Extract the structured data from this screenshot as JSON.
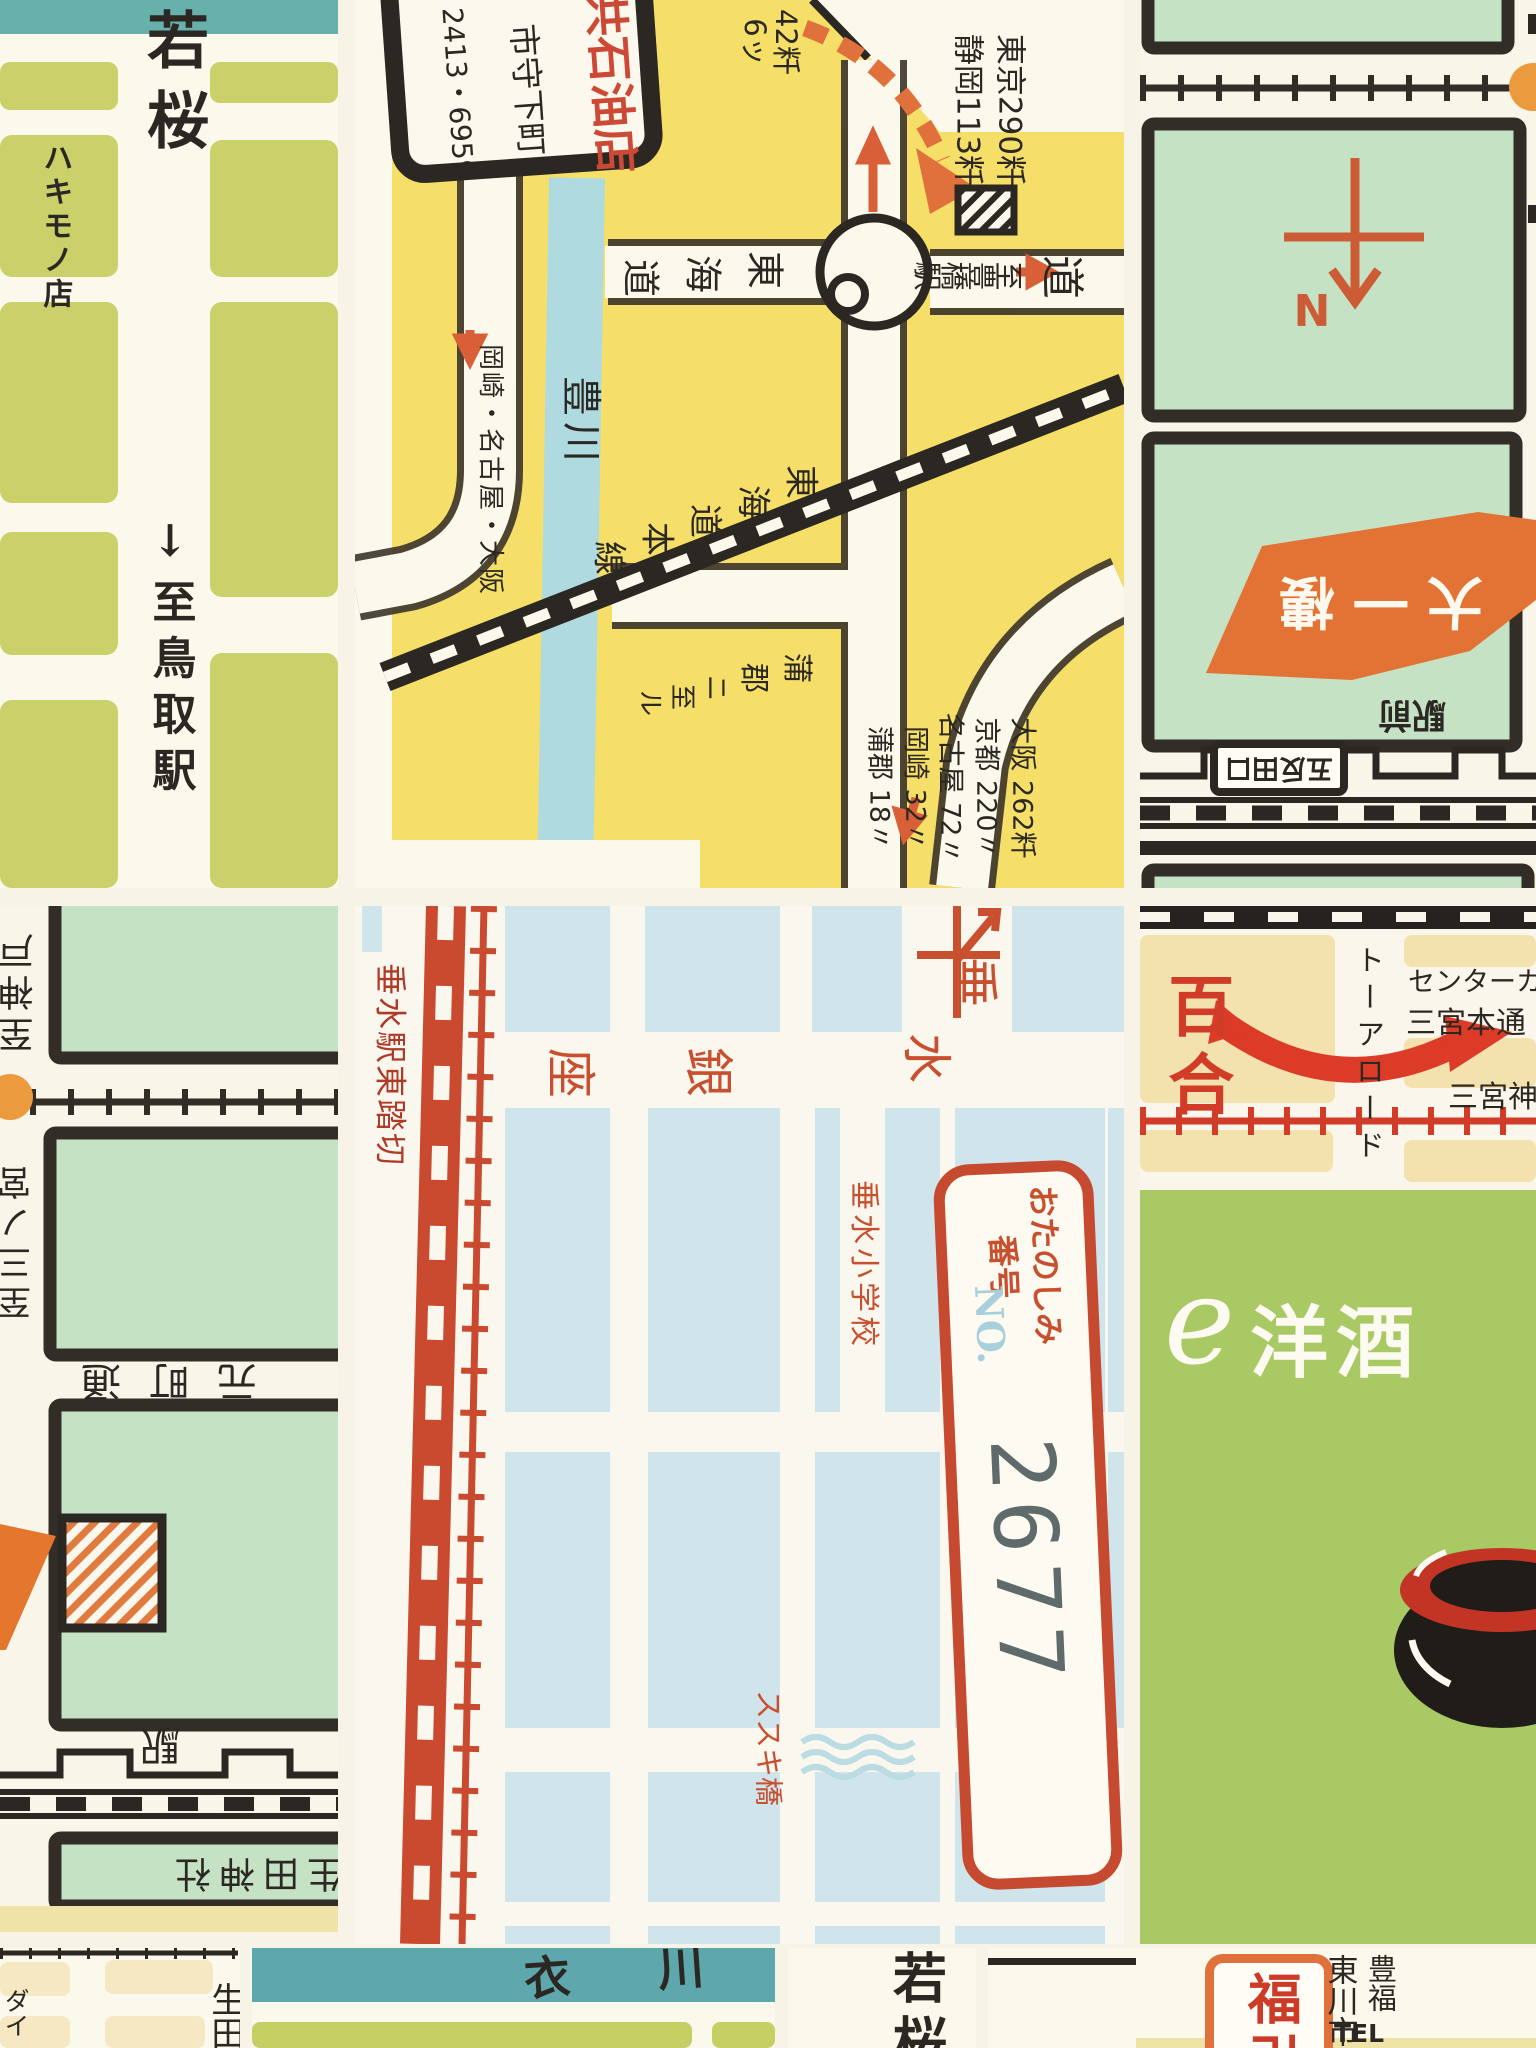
{
  "p1": {
    "street_name": "若桜",
    "shop": "ハキモノ店",
    "to_station": "↓至鳥取駅"
  },
  "p2": {
    "sign_shop": "共石油店",
    "sign_town": "市守下町",
    "sign_phone": "2413・6959",
    "km_small": [
      "42粁",
      "6ッ"
    ],
    "km_top": [
      "東京290粁",
      "静岡113粁"
    ],
    "river": "豊川",
    "road_dest": "岡崎・名古屋・大阪",
    "tokaido": [
      "東",
      "海",
      "道"
    ],
    "rail": [
      "東",
      "海",
      "道",
      "本",
      "線"
    ],
    "gamagori": [
      "蒲",
      "郡",
      "ニ",
      "至",
      "ル"
    ],
    "to_station": [
      "至",
      "豊",
      "橋",
      "駅"
    ],
    "road_char": "道",
    "km_list": [
      "大阪 262粁",
      "京都 220〃",
      "名古屋 72〃",
      "岡崎 32〃",
      "蒲郡 18〃"
    ]
  },
  "p3": {
    "compass": "N",
    "banner": "大一樓",
    "station_sign": "五反田口",
    "ekimae": "駅前"
  },
  "p4": {
    "to_kobe": "至神戸",
    "to_sannomiya": "至三ノ宮",
    "motomachi": "元町通",
    "station": "駅",
    "shrine": "生田神社"
  },
  "p5": {
    "crossing": "垂水駅東踏切",
    "school": "垂水小学校",
    "ginza": [
      "垂",
      "水",
      "銀",
      "座"
    ],
    "bridge": "ススキ橋",
    "stamp_line1": "おたのしみ",
    "stamp_line2": "番号",
    "stamp_no": "NO.",
    "stamp_number": "2677"
  },
  "p6": {
    "yuri": "百合",
    "tor_road": "トーアロード",
    "center": "センターカ",
    "hondori": "三宮本通",
    "jinja": "三宮神",
    "script": "e",
    "yoshu": "洋酒"
  },
  "p7": {
    "ikuta": "生田",
    "edge": "ダイ"
  },
  "p8": {
    "name": "衣 川"
  },
  "p9": {
    "street_name": "若桜"
  },
  "p10": {
    "fuku": "福引",
    "col1": "東川市",
    "col2": "豊福",
    "tel": "TEL"
  }
}
